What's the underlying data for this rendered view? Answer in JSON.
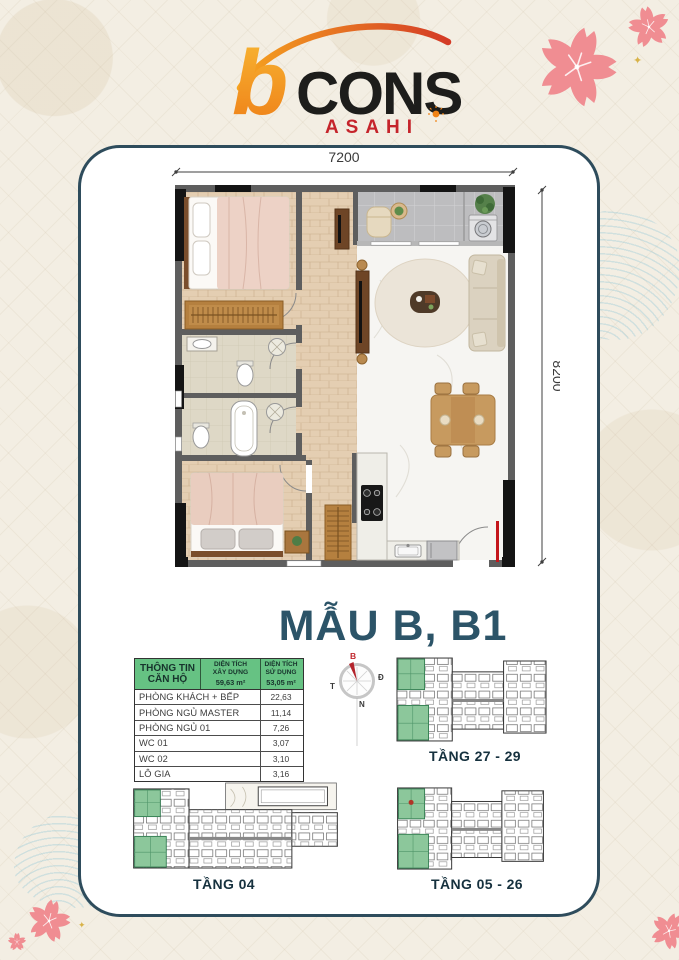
{
  "brand": {
    "b": "b",
    "name": "CONS",
    "sub": "ASAHI"
  },
  "plan": {
    "title": "MẪU B, B1",
    "width_label": "7200",
    "height_label": "8200"
  },
  "compass": {
    "north": "B",
    "east": "Đ",
    "west": "T",
    "south": "N"
  },
  "unit_table": {
    "header_title": "THÔNG TIN CĂN HỘ",
    "col_built": {
      "line1": "DIỆN TÍCH",
      "line2": "XÂY DỰNG",
      "value": "59,63 m²"
    },
    "col_usable": {
      "line1": "DIỆN TÍCH",
      "line2": "SỬ DỤNG",
      "value": "53,05 m²"
    },
    "rows": [
      {
        "label": "PHÒNG KHÁCH + BẾP",
        "value": "22,63"
      },
      {
        "label": "PHÒNG NGỦ MASTER",
        "value": "11,14"
      },
      {
        "label": "PHÒNG NGỦ 01",
        "value": "7,26"
      },
      {
        "label": "WC 01",
        "value": "3,07"
      },
      {
        "label": "WC 02",
        "value": "3,10"
      },
      {
        "label": "LÔ GIA",
        "value": "3,16"
      }
    ]
  },
  "floors": [
    {
      "label": "TẦNG 27 - 29"
    },
    {
      "label": "TẦNG 04"
    },
    {
      "label": "TẦNG 05 - 26"
    }
  ],
  "icons": {
    "sparkle": "✦"
  },
  "colors": {
    "accent_teal": "#2e4c5c",
    "table_green": "#66c283",
    "brand_red": "#c5242b",
    "brand_yellow": "#f5a81c",
    "sakura_pink": "#f08d92",
    "highlight_unit_green": "#8cc79b",
    "marker_red": "#c4161c"
  }
}
